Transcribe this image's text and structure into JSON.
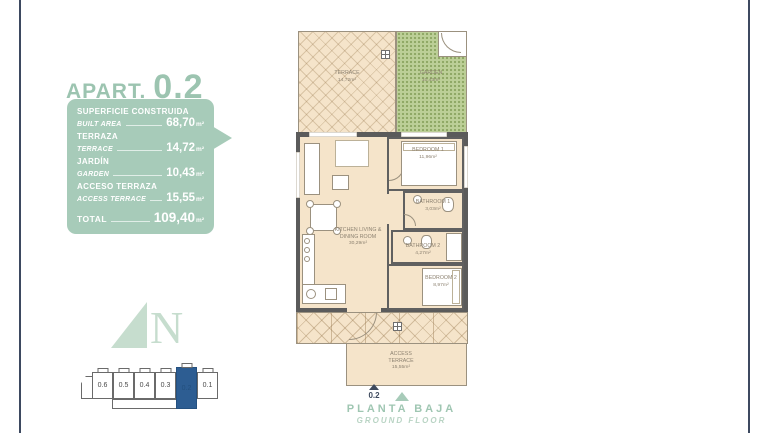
{
  "accent_color": "#9cc4b0",
  "title": {
    "word": "APART.",
    "number": "0.2"
  },
  "info_box": {
    "rows": [
      {
        "label_es": "SUPERFICIE CONSTRUIDA",
        "label_en": "BUILT AREA",
        "value": "68,70",
        "unit": "m²"
      },
      {
        "label_es": "TERRAZA",
        "label_en": "TERRACE",
        "value": "14,72",
        "unit": "m²"
      },
      {
        "label_es": "JARDÍN",
        "label_en": "GARDEN",
        "value": "10,43",
        "unit": "m²"
      },
      {
        "label_es": "ACCESO TERRAZA",
        "label_en": "ACCESS TERRACE",
        "value": "15,55",
        "unit": "m²"
      }
    ],
    "total_label": "TOTAL",
    "total_value": "109,40",
    "total_unit": "m²"
  },
  "compass": {
    "letter": "N"
  },
  "key_plan": {
    "units": [
      "0.6",
      "0.5",
      "0.4",
      "0.3",
      "0.2",
      "0.1"
    ],
    "highlighted_unit": "0.2",
    "highlight_color": "#2d5d92"
  },
  "floor_plan": {
    "rooms": {
      "terrace": {
        "name": "TERRACE",
        "area": "14,72m²"
      },
      "garden": {
        "name": "GARDEN",
        "area": "10,43m²"
      },
      "bedroom1": {
        "name": "BEDROOM 1",
        "area": "11,96m²"
      },
      "bathroom1": {
        "name": "BATHROOM 1",
        "area": "3,03m²"
      },
      "bathroom2": {
        "name": "BATHROOM 2",
        "area": "4,27m²"
      },
      "bedroom2": {
        "name": "BEDROOM 2",
        "area": "8,97m²"
      },
      "kitchen_living": {
        "name": "KITCHEN LIVING & DINING ROOM",
        "area": "30,29m²"
      },
      "access_terrace": {
        "name": "ACCESS TERRACE",
        "area": "15,55m²"
      }
    },
    "entrance_marker": "0.2"
  },
  "footer": {
    "floor_es": "PLANTA BAJA",
    "floor_en": "GROUND FLOOR"
  }
}
